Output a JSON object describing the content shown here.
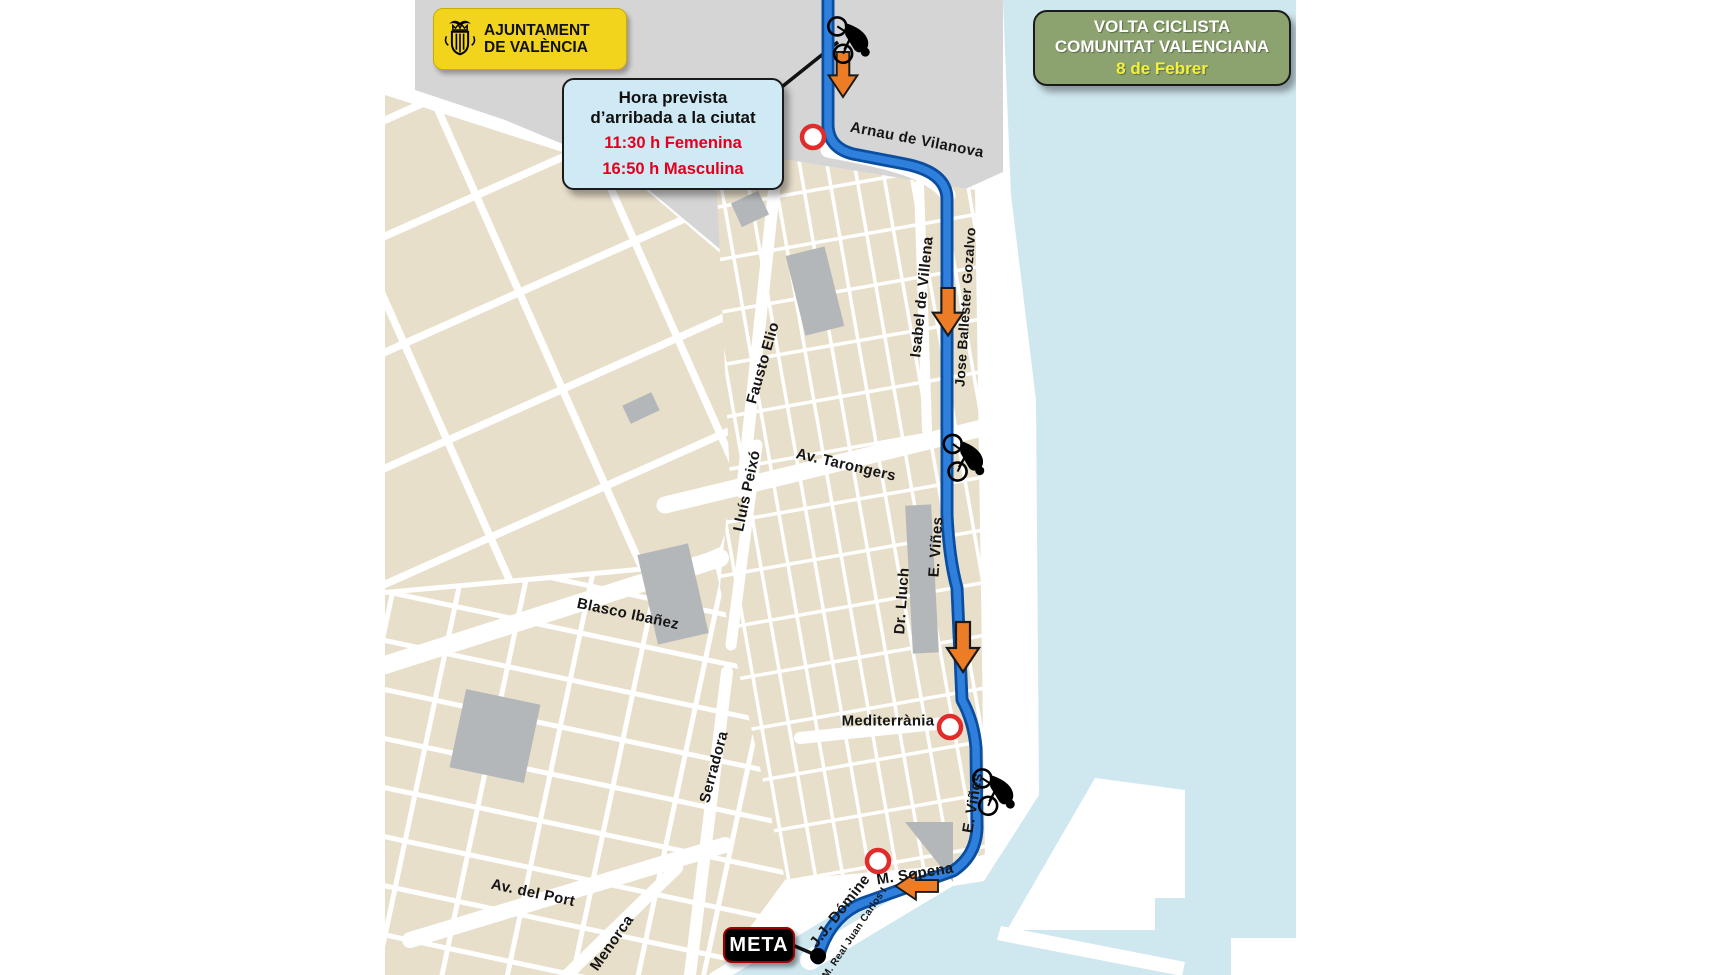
{
  "brand": {
    "line1": "AJUNTAMENT",
    "line2": "DE VALÈNCIA"
  },
  "event": {
    "line1": "VOLTA CICLISTA",
    "line2": "COMUNITAT VALENCIANA",
    "date": "8 de Febrer"
  },
  "callout": {
    "title1": "Hora prevista",
    "title2": "d’arribada a la ciutat",
    "female": "11:30 h Femenina",
    "male": "16:50 h Masculina"
  },
  "finish": {
    "label": "META"
  },
  "streets": [
    {
      "name": "Arnau de Vilanova"
    },
    {
      "name": "Isabel de Villena"
    },
    {
      "name": "Jose Ballester Gozalvo"
    },
    {
      "name": "Fausto Elio"
    },
    {
      "name": "Av. Tarongers"
    },
    {
      "name": "Lluís Peixó"
    },
    {
      "name": "E. Viñes"
    },
    {
      "name": "Dr. Lluch"
    },
    {
      "name": "Blasco Ibañez"
    },
    {
      "name": "Mediterrània"
    },
    {
      "name": "Serradora"
    },
    {
      "name": "E. Viñes"
    },
    {
      "name": "M. Sopena"
    },
    {
      "name": "Av. del Port"
    },
    {
      "name": "J.J. Dómine"
    },
    {
      "name": "Menorca"
    },
    {
      "name": "M. Real Juan Carlos I"
    }
  ],
  "colors": {
    "sea": "#cfe7ef",
    "block": "#e8dfca",
    "campus_gray": "#d5d5d5",
    "building_gray": "#b4b7ba",
    "route_outer": "#0b4ea0",
    "route_inner": "#2e80dc",
    "arrow_orange": "#ec7c26",
    "control_red": "#e12c2c",
    "badge_yellow": "#f2d41c",
    "badge_green": "#8ca370",
    "callout_blue": "#cfeaf4",
    "time_red": "#e2001e"
  }
}
